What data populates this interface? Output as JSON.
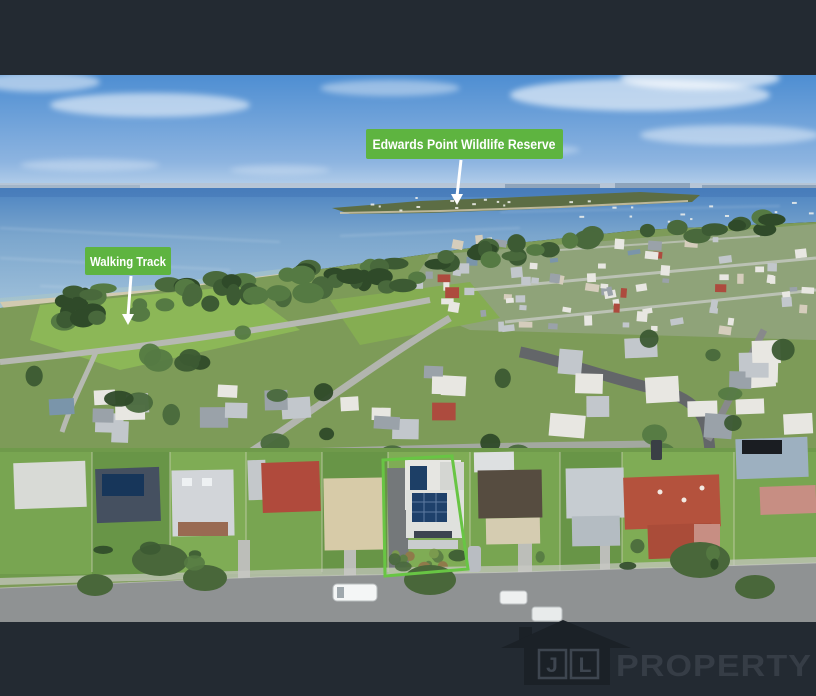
{
  "annotations": {
    "reserve": {
      "label": "Edwards Point Wildlife Reserve",
      "arrow": "down-arrow-icon"
    },
    "walking_track": {
      "label": "Walking Track",
      "arrow": "down-arrow-icon"
    }
  },
  "watermark": {
    "house_icon": "house-icon",
    "letter_j": "J",
    "letter_l": "L",
    "brand": "PROPERTY"
  },
  "colors": {
    "badge_green": "#5eb440",
    "outline_green": "#68c544",
    "arrow_white": "#ffffff",
    "bar_dark": "#232a32",
    "logo_house": "#1b2127",
    "logo_accent": "#3e4650",
    "logo_text": "#363d46"
  }
}
